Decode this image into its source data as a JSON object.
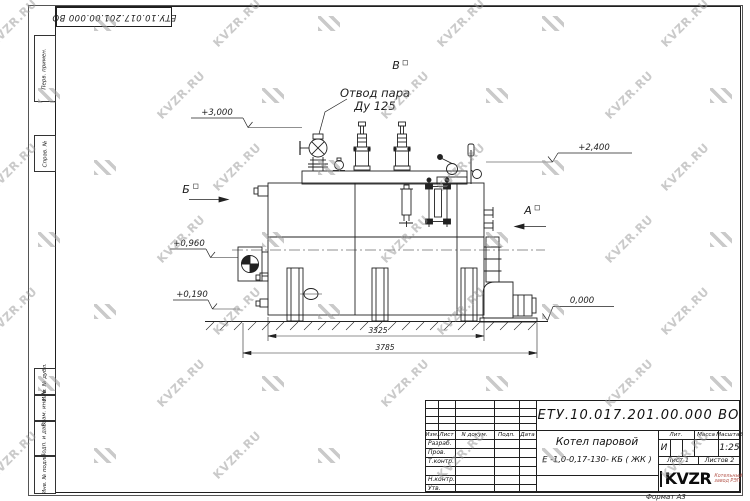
{
  "sheet": {
    "watermark_text": "KVZR.RU",
    "format_note": "Формат А3"
  },
  "corner_stamp": {
    "doc_number": "ЕТУ.10.017.201.00.000  ВО"
  },
  "margin": {
    "labels": [
      "Перв. примен.",
      "Справ. №",
      "Инв. № дубл.",
      "Взам. инв. №",
      "Подп. и дата",
      "Инв. № подл."
    ]
  },
  "drawing": {
    "callout": {
      "line1": "Отвод пара",
      "line2": "Ду 125"
    },
    "views": {
      "a": "А",
      "b": "Б",
      "v": "В"
    },
    "elevations": {
      "e3000": "+3,000",
      "e2400": "+2,400",
      "e0960": "+0,960",
      "e0190": "+0,190",
      "e0000": "0,000"
    },
    "dimensions": {
      "inner": "3325",
      "outer": "3785"
    }
  },
  "title_block": {
    "doc_number": "ЕТУ.10.017.201.00.000  ВО",
    "product_name_line1": "Котел паровой",
    "product_name_line2": "Е -1,0-0,17-130- КБ ( ЖК )",
    "col_headers": {
      "izm": "Изм.",
      "list": "Лист",
      "n_dokum": "N докум.",
      "podp": "Подп.",
      "data": "Дата"
    },
    "sign_rows": [
      "Разраб.",
      "Пров.",
      "Т.контр.",
      "",
      "Н.контр.",
      "Утв."
    ],
    "lit_header": "Лит.",
    "mass_header": "Масса",
    "scale_header": "Масштаб",
    "lit_value": "И",
    "scale_value": "1:25",
    "sheet_cell": "Лист 1",
    "sheets_cell": "Листов 2",
    "logo": {
      "text": "KVZR",
      "tagline_line1": "Котельный",
      "tagline_line2": "завод РЭП"
    }
  }
}
